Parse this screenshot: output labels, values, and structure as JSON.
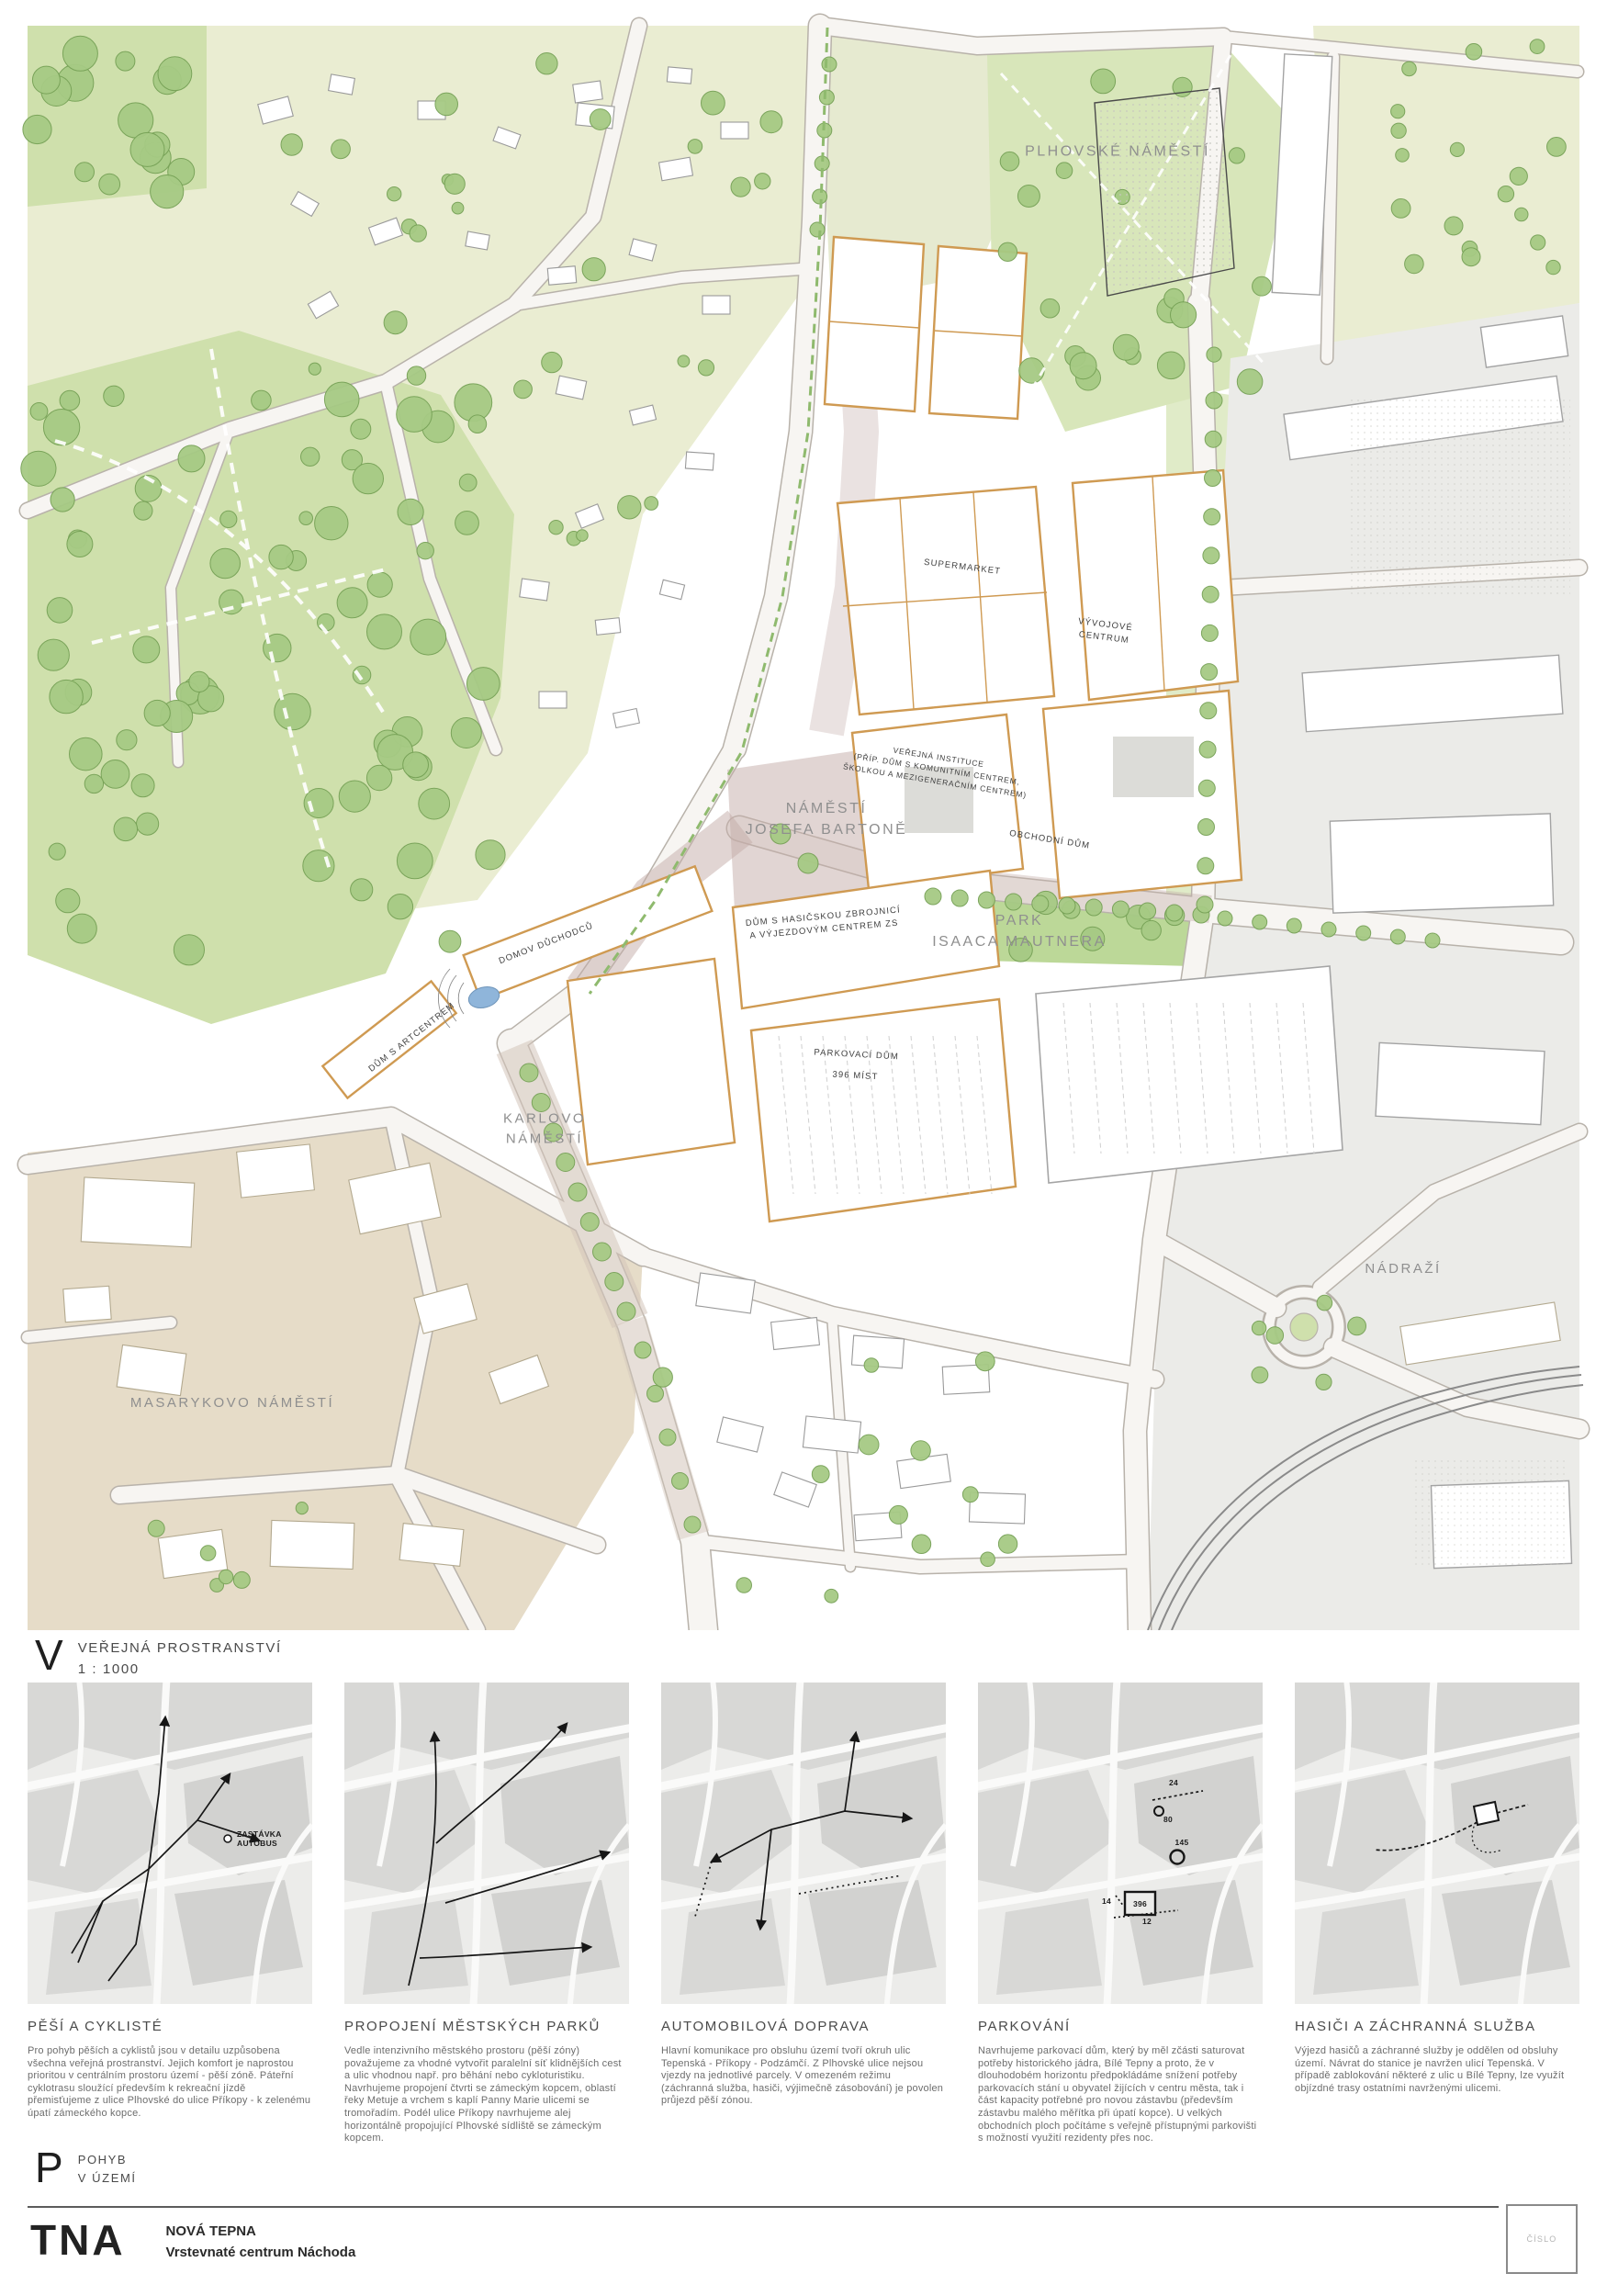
{
  "header_v": {
    "letter": "V",
    "title": "VEŘEJNÁ PROSTRANSTVÍ",
    "scale": "1 : 1000"
  },
  "header_p": {
    "letter": "P",
    "line1": "POHYB",
    "line2": "V ÚZEMÍ"
  },
  "footer": {
    "logo": "TNA",
    "project": "NOVÁ TEPNA",
    "subtitle": "Vrstevnaté centrum Náchoda",
    "stamp": "ČÍSLO"
  },
  "map_labels": {
    "plhovske_namesti": "PLHOVSKÉ NÁMĚSTÍ",
    "supermarket": "SUPERMARKET",
    "vyvojove_centrum": "VÝVOJOVÉ\nCENTRUM",
    "verejna_instituce": "VEŘEJNÁ INSTITUCE\n(PŘÍP. DŮM S KOMUNITNÍM CENTREM,\nŠKOLKOU A MEZIGENERAČNÍM CENTREM)",
    "namesti_josefa_bartone": "NÁMĚSTÍ\nJOSEFA BARTONĚ",
    "obchodni_dum": "OBCHODNÍ DŮM",
    "park_isaaca_mautnera": "PARK\nISAACA MAUTNERA",
    "dum_s_hasicskou": "DŮM S HASIČSKOU ZBROJNICÍ\nA VÝJEZDOVÝM CENTREM ZS",
    "domov_duchodcu": "DOMOV DŮCHODCŮ",
    "dum_s_artcentrem": "DŮM S ARTCENTREM",
    "parkovaci_dum": "PARKOVACÍ DŮM\n\n396 MÍST",
    "karlovo_namesti": "KARLOVO\nNÁMĚSTÍ",
    "masarykovo_namesti": "MASARYKOVO NÁMĚSTÍ",
    "nadrazi": "NÁDRAŽÍ"
  },
  "panels": [
    {
      "title": "PĚŠÍ A CYKLISTÉ",
      "text": "Pro pohyb pěších a cyklistů jsou v detailu uzpůsobena všechna veřejná prostranství. Jejich komfort je naprostou prioritou v centrálním prostoru území - pěší zóně. Páteřní cyklotrasu sloužící především k rekreační jízdě přemisťujeme z ulice Plhovské do ulice Příkopy - k zelenému úpatí zámeckého kopce.",
      "annotation": {
        "line1": "ZASTÁVKA",
        "line2": "AUTOBUS"
      }
    },
    {
      "title": "PROPOJENÍ MĚSTSKÝCH PARKŮ",
      "text": "Vedle intenzivního městského prostoru (pěší zóny) považujeme za vhodné vytvořit paralelní síť klidnějších cest a ulic vhodnou např. pro běhání nebo cykloturistiku. Navrhujeme propojení čtvrti se zámeckým kopcem, oblastí řeky Metuje a vrchem s kaplí Panny Marie ulicemi se tromořadím. Podél ulice Příkopy navrhujeme alej horizontálně propojující Plhovské sídliště se zámeckým kopcem."
    },
    {
      "title": "AUTOMOBILOVÁ DOPRAVA",
      "text": "Hlavní komunikace pro obsluhu území tvoří okruh ulic Tepenská - Příkopy - Podzámčí. Z Plhovské ulice nejsou vjezdy na jednotlivé parcely. V omezeném režimu (záchranná služba, hasiči, výjimečně zásobování) je povolen průjezd pěší zónou."
    },
    {
      "title": "PARKOVÁNÍ",
      "text": "Navrhujeme parkovací dům, který by měl zčásti saturovat potřeby historického jádra, Bílé Tepny a proto, že v dlouhodobém horizontu předpokládáme snížení potřeby parkovacích stání u obyvatel žijících v centru města, tak i část kapacity potřebné pro novou zástavbu (především zástavbu malého měřítka při úpatí kopce). U velkých obchodních ploch počítáme s veřejně přístupnými parkovišti s možností využití rezidenty přes noc.",
      "markers": [
        "24",
        "80",
        "145",
        "396",
        "14",
        "12"
      ]
    },
    {
      "title": "HASIČI A ZÁCHRANNÁ SLUŽBA",
      "text": "Výjezd hasičů a záchranné služby je oddělen od obsluhy území. Návrat do stanice je navržen ulicí Tepenská. V případě zablokování některé z ulic u Bílé Tepny, lze využít objízdné trasy ostatními navrženými ulicemi."
    }
  ],
  "colors": {
    "accent_orange": "#cf9a52",
    "park_green": "#a6ca84",
    "pedestrian_mauve": "#c3aca8",
    "water_blue": "#8fb5da"
  }
}
